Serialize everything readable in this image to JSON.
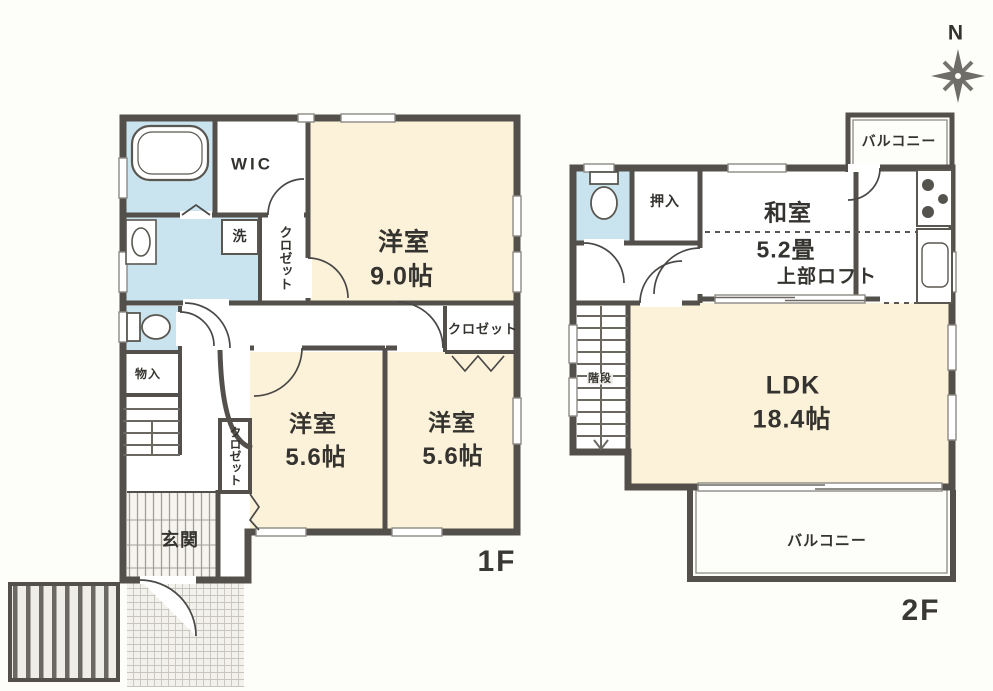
{
  "compass": {
    "north": "N"
  },
  "floor1": {
    "label": "1F",
    "wic": "WIC",
    "bedroom_9": {
      "name": "洋室",
      "size": "9.0帖"
    },
    "bedroom_56_left": {
      "name": "洋室",
      "size": "5.6帖"
    },
    "bedroom_56_right": {
      "name": "洋室",
      "size": "5.6帖"
    },
    "closet_washroom": "クロゼット",
    "closet_bedroom_left": "クロゼット",
    "closet_bedroom_right": "クロゼット",
    "laundry": "洗",
    "storage": "物入",
    "entrance": "玄関"
  },
  "floor2": {
    "label": "2F",
    "balcony_top": "バルコニー",
    "balcony_bottom": "バルコニー",
    "oshiire": "押入",
    "japanese_room": {
      "name": "和室",
      "size": "5.2畳",
      "loft": "上部ロフト"
    },
    "ldk": {
      "name": "LDK",
      "size": "18.4帖"
    },
    "stairs": "階段"
  },
  "colors": {
    "wall": "#53504b",
    "room_fill": "#fbf2d9",
    "wet_area_fill": "#c9e4ee",
    "paper": "#fdfdfa"
  }
}
